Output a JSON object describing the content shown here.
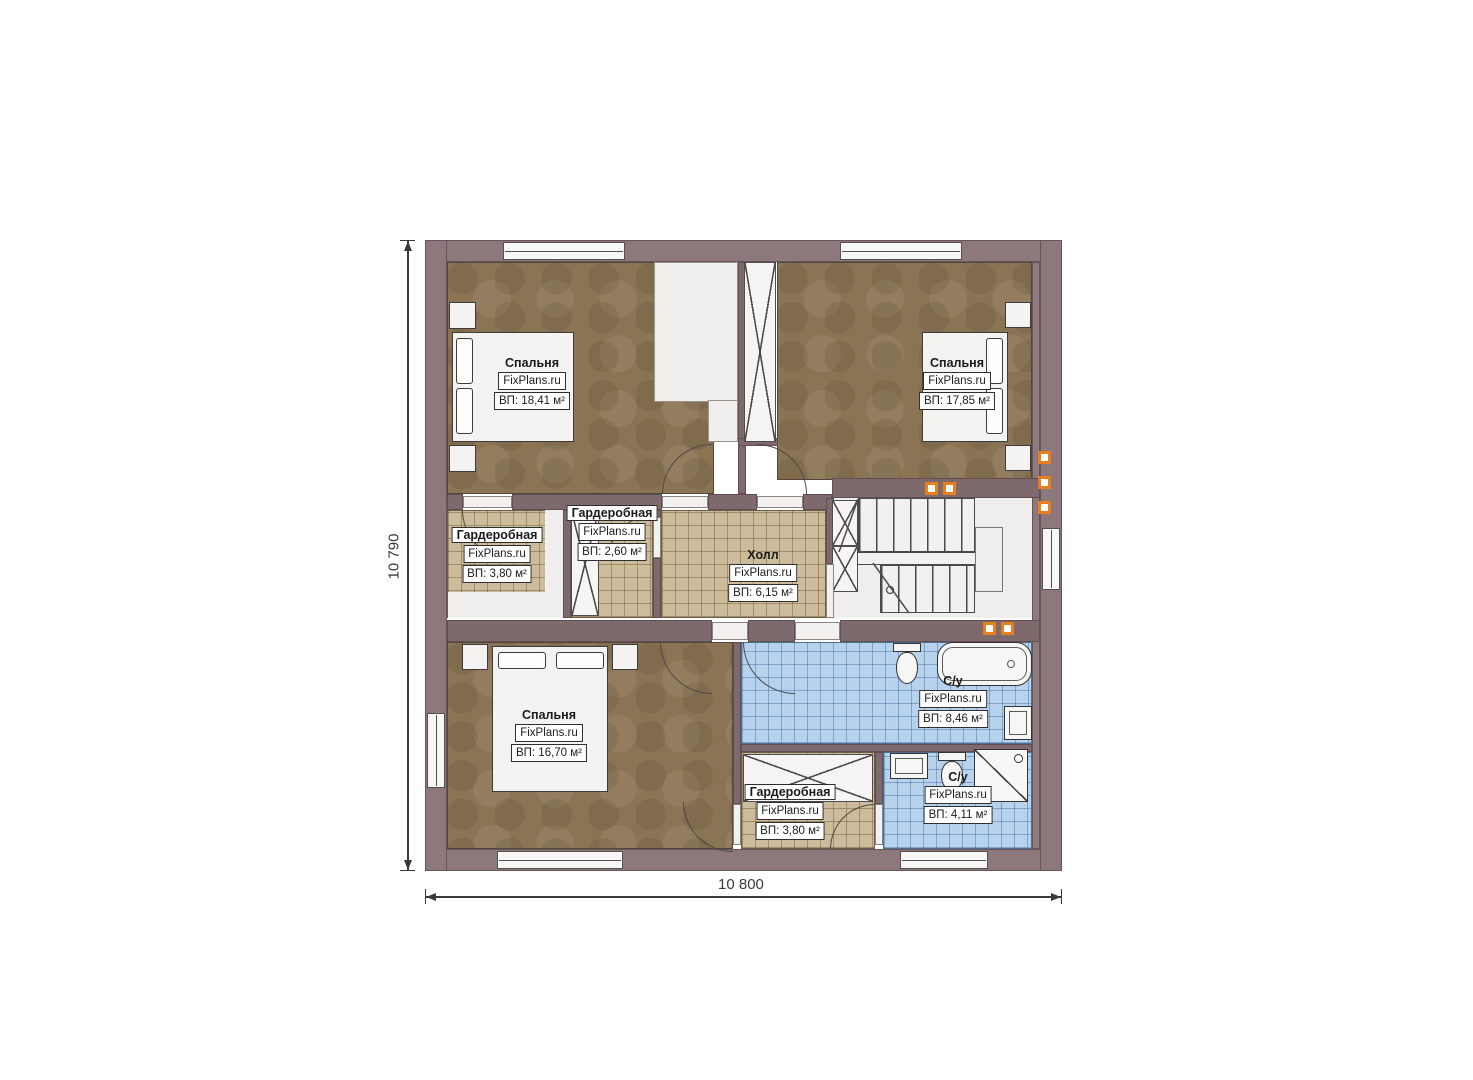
{
  "plan_title": "floor-plan-second-level",
  "dimensions": {
    "width": "10 800",
    "height": "10 790"
  },
  "rooms": [
    {
      "id": "bedroom-top-left",
      "name": "Спальня",
      "brand": "FixPlans.ru",
      "area": "ВП: 18,41 м²"
    },
    {
      "id": "bedroom-top-right",
      "name": "Спальня",
      "brand": "FixPlans.ru",
      "area": "ВП: 17,85 м²"
    },
    {
      "id": "wardrobe-left",
      "name": "Гардеробная",
      "brand": "FixPlans.ru",
      "area": "ВП: 3,80 м²"
    },
    {
      "id": "wardrobe-middle",
      "name": "Гардеробная",
      "brand": "FixPlans.ru",
      "area": "ВП: 2,60 м²"
    },
    {
      "id": "hall",
      "name": "Холл",
      "brand": "FixPlans.ru",
      "area": "ВП: 6,15 м²"
    },
    {
      "id": "bedroom-bottom",
      "name": "Спальня",
      "brand": "FixPlans.ru",
      "area": "ВП: 16,70 м²"
    },
    {
      "id": "bathroom-top",
      "name": "С/у",
      "brand": "FixPlans.ru",
      "area": "ВП: 8,46 м²"
    },
    {
      "id": "wardrobe-bottom",
      "name": "Гардеробная",
      "brand": "FixPlans.ru",
      "area": "ВП: 3,80 м²"
    },
    {
      "id": "bathroom-bottom",
      "name": "С/у",
      "brand": "FixPlans.ru",
      "area": "ВП: 4,11 м²"
    }
  ],
  "icons": {
    "bed": "bed-icon",
    "toilet": "toilet-icon",
    "bathtub": "bathtub-icon",
    "shower": "shower-icon",
    "sink": "sink-icon",
    "stairs": "stairs-icon",
    "door": "door-arc-icon",
    "window": "window-icon",
    "shaft": "vent-shaft-icon",
    "marker": "orange-marker-icon"
  },
  "colors": {
    "wall": "#8d797c",
    "floor": "#8b7454",
    "tile_tan": "#cdbc9b",
    "tile_blue": "#b7d2ec",
    "marker": "#e87f1e"
  }
}
